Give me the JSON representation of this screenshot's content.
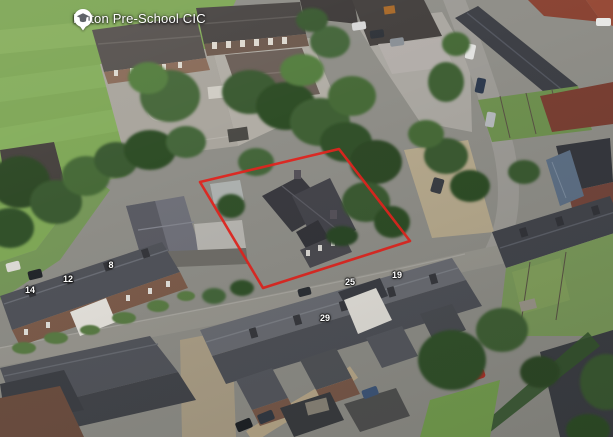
{
  "poi_marker": {
    "label": "Milton Pre-School CIC",
    "icon": "graduation-cap-icon",
    "icon_bg_color": "#ffffff",
    "icon_glyph_color": "#5f6368",
    "label_color": "#ffffff"
  },
  "property_boundary": {
    "color": "#e2251f",
    "stroke_width": "2.6",
    "points": "339,149 410,241 263,288 200,182"
  },
  "house_numbers": [
    {
      "value": "14"
    },
    {
      "value": "12"
    },
    {
      "value": "8"
    },
    {
      "value": "29"
    },
    {
      "value": "25"
    },
    {
      "value": "19"
    }
  ],
  "palette": {
    "field_green": "#7fa757",
    "tree_green": "#3a5a30",
    "street_gray": "#98968f",
    "tarmac_gray": "#a9a59d",
    "slate_roof": "#4c4e55",
    "brick_wall": "#7c5b4a",
    "red_roof": "#8a4434",
    "gravel_tan": "#b6a98d"
  }
}
